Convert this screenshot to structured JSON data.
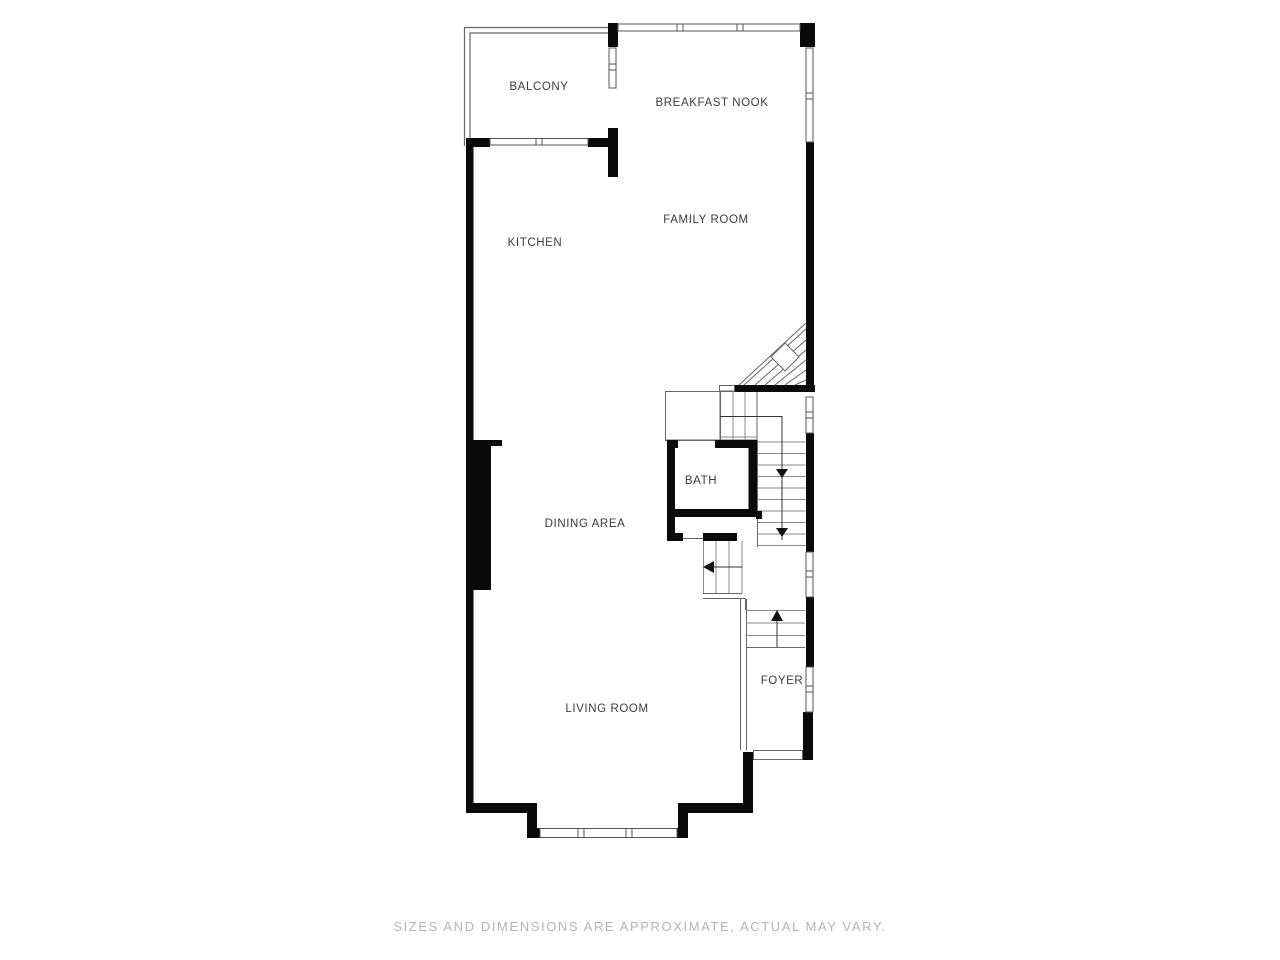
{
  "plan": {
    "type": "floor-plan",
    "rooms": {
      "balcony": {
        "label": "BALCONY"
      },
      "breakfast_nook": {
        "label": "BREAKFAST NOOK"
      },
      "family_room": {
        "label": "FAMILY ROOM"
      },
      "kitchen": {
        "label": "KITCHEN"
      },
      "bath": {
        "label": "BATH"
      },
      "dining_area": {
        "label": "DINING AREA"
      },
      "living_room": {
        "label": "LIVING ROOM"
      },
      "foyer": {
        "label": "FOYER"
      }
    },
    "stair_arrows": [
      "down",
      "down",
      "left",
      "up"
    ],
    "features": [
      "winder-stairs",
      "straight-stairs",
      "windows",
      "balcony-railing",
      "fireplace-chase",
      "entry-threshold"
    ]
  },
  "footer": {
    "disclaimer": "SIZES AND DIMENSIONS ARE APPROXIMATE, ACTUAL MAY VARY."
  },
  "colors": {
    "background": "#ffffff",
    "wall": "#0a0a0a",
    "thin_line": "#666666",
    "tread_line": "#8a8a8a",
    "label_text": "#3c3c3c",
    "footer_text": "#b5b5b5"
  }
}
